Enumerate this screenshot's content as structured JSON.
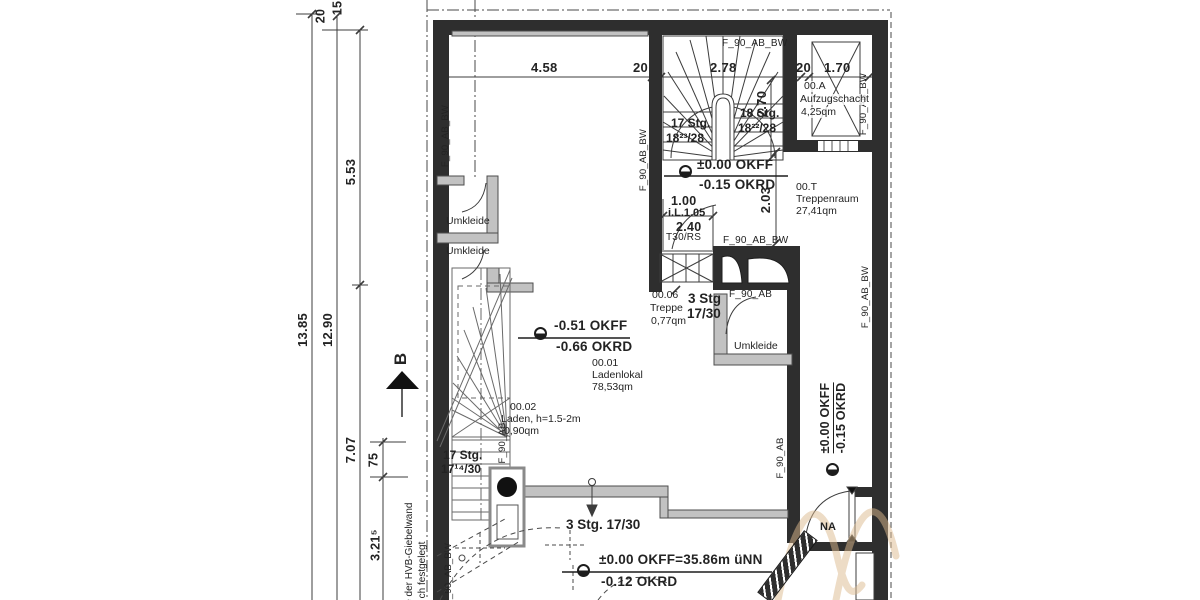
{
  "drawing_type": "architectural floor plan (ground floor shop / stairwell)",
  "texts": {
    "dims": {
      "d20_top": "20",
      "d15_top": "15",
      "d1385": "13.85",
      "d1290": "12.90",
      "d553": "5.53",
      "d707": "7.07",
      "d75": "75",
      "d3215": "3.21⁵",
      "d458": "4.58",
      "d20a": "20",
      "d278": "2.78",
      "d20b": "20",
      "d170": "1.70",
      "d270": "2.70",
      "d203": "2.03",
      "d100": "1.00",
      "d105": "i.L.1.05",
      "d240": "2.40"
    },
    "fire": {
      "t30": "T30/RS",
      "f90abbw": "F_90_AB_BW",
      "f90ab": "F_90_AB"
    },
    "rooms": {
      "aufzug_no": "00.A",
      "aufzug_name": "Aufzugschacht",
      "aufzug_area": "4,25qm",
      "tr_no": "00.T",
      "tr_name": "Treppenraum",
      "tr_area": "27,41qm",
      "laden_no": "00.01",
      "laden_name": "Ladenlokal",
      "laden_area": "78,53qm",
      "laden2_no": "00.02",
      "laden2_name": "Laden, h=1.5-2m",
      "laden2_area": "0,90qm",
      "treppe_no": "00.06",
      "treppe_name": "Treppe",
      "treppe_area": "0,77qm",
      "umkleide": "Umkleide"
    },
    "stairs": {
      "s17a": "17 Stg.",
      "s17a_r": "18²³/28",
      "s18": "18 Stg.",
      "s18_r": "18²²/28",
      "s3": "3 Stg",
      "s3_r": "17/30",
      "s17b": "17 Stg.",
      "s17b_r": "17¹⁴/30",
      "s3b": "3 Stg. 17/30"
    },
    "levels": {
      "okff0": "±0.00 OKFF",
      "okrd015": "-0.15 OKRD",
      "okff051": "-0.51 OKFF",
      "okrd066": "-0.66 OKRD",
      "okff_nn": "±0.00 OKFF=35.86m üNN",
      "okrd012": "-0.12 OKRD"
    },
    "misc": {
      "na": "NA",
      "section_b": "B",
      "giebel1": "Lage der HVB-Giebelwand",
      "giebel2": "ch festgelegt"
    }
  },
  "colors": {
    "wall": "#2e2e2e",
    "partition": "#c2c2c2",
    "line": "#3c3c3c",
    "watermark": "#ddba8e",
    "background": "#ffffff"
  }
}
